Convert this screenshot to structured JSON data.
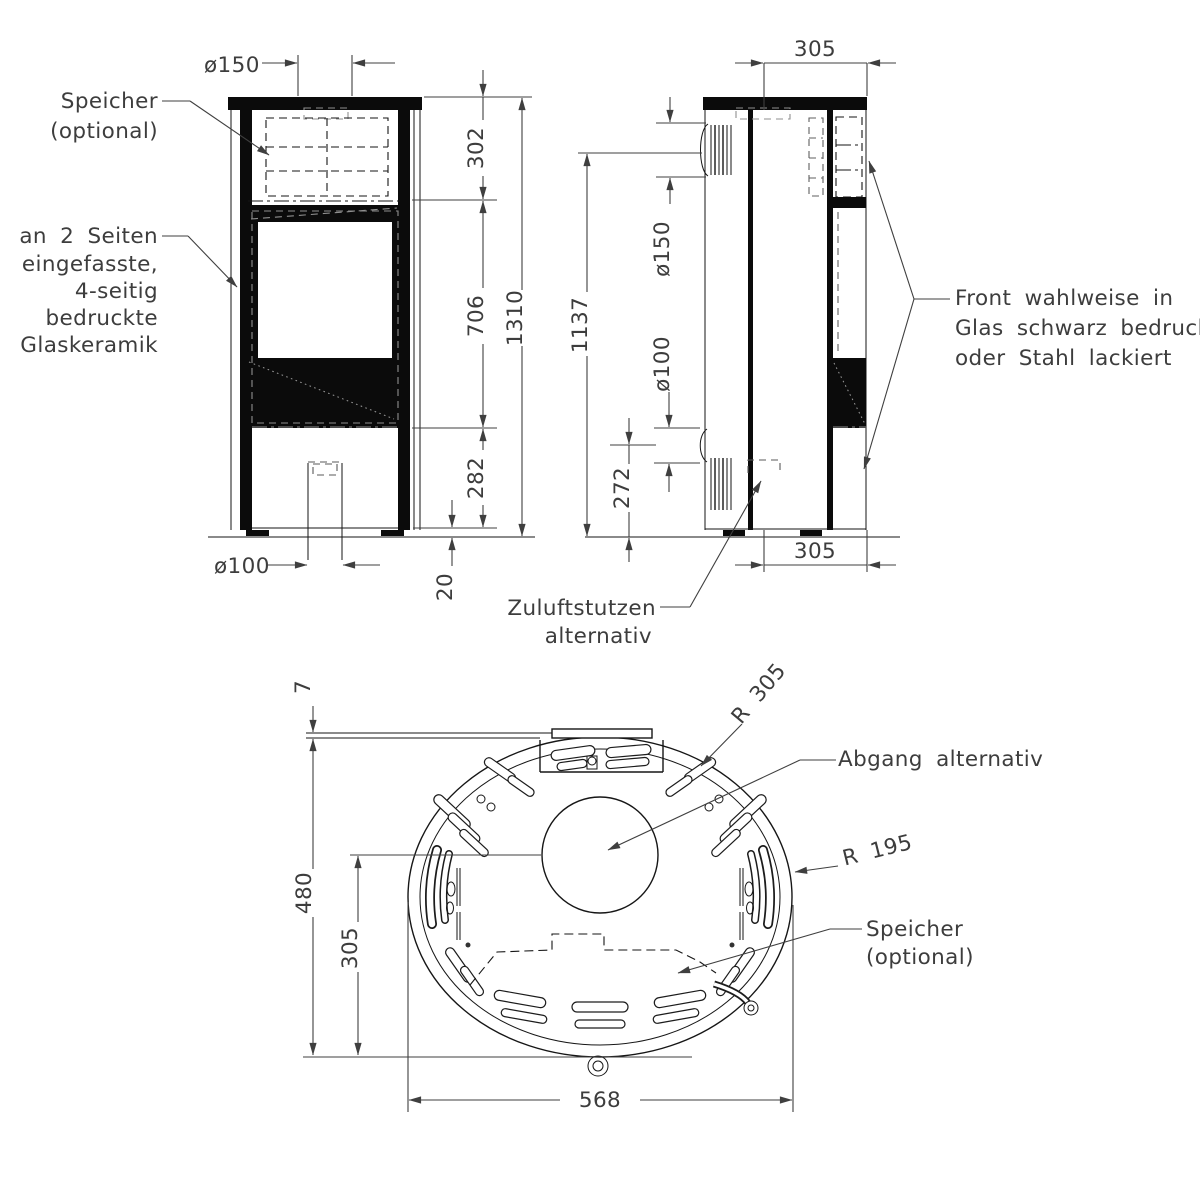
{
  "front": {
    "d150": "ø150",
    "d302": "302",
    "d706": "706",
    "d282": "282",
    "d1310": "1310",
    "d20": "20",
    "d100": "ø100",
    "speicher1": "Speicher",
    "speicher2": "(optional)",
    "glas1": "an 2 Seiten",
    "glas2": "eingefasste,",
    "glas3": "4-seitig",
    "glas4": "bedruckte",
    "glas5": "Glaskeramik"
  },
  "side": {
    "d305top": "305",
    "d150": "ø150",
    "d100": "ø100",
    "d1137": "1137",
    "d272": "272",
    "d305bottom": "305",
    "front1": "Front wahlweise in",
    "front2": "Glas schwarz bedruckt",
    "front3": "oder Stahl lackiert",
    "zuluft1": "Zuluftstutzen",
    "zuluft2": "alternativ"
  },
  "top": {
    "d7": "7",
    "d480": "480",
    "d305": "305",
    "d568": "568",
    "r305": "R 305",
    "r195": "R 195",
    "abgang": "Abgang alternativ",
    "speicher1": "Speicher",
    "speicher2": "(optional)"
  }
}
